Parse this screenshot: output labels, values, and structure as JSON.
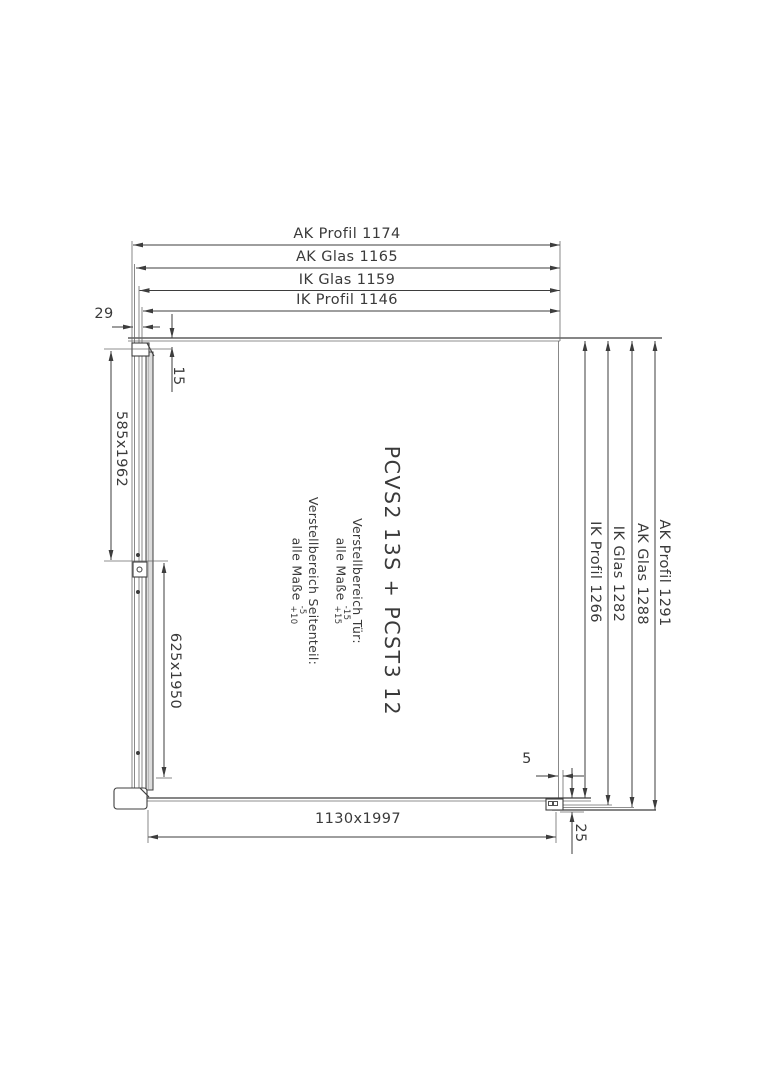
{
  "labels": {
    "top_ak_profil": "AK Profil 1174",
    "top_ak_glas": "AK Glas 1165",
    "top_ik_glas": "IK Glas 1159",
    "top_ik_profil": "IK Profil 1146",
    "right_ik_profil": "IK Profil 1266",
    "right_ik_glas": "IK Glas 1282",
    "right_ak_glas": "AK Glas 1288",
    "right_ak_profil": "AK Profil 1291",
    "wall_profile_width": "29",
    "top_inset": "15",
    "door_glass_size": "585x1962",
    "door_assembly_size": "625x1950",
    "side_panel_size": "1130x1997",
    "bottom_gap": "5",
    "bottom_rail_height": "25"
  },
  "center": {
    "product": "PCVS2 13S + PCST3 12",
    "door_adjust_title": "Verstellbereich Tür:",
    "door_adjust_prefix": "alle Maße",
    "door_tol_top": "-15",
    "door_tol_bottom": "+15",
    "side_adjust_title": "Verstellbereich Seitenteil:",
    "side_adjust_prefix": "alle Maße",
    "side_tol_top": "-5",
    "side_tol_bottom": "+10"
  },
  "colors": {
    "line": "#3d3d3d",
    "text": "#3a3a3a",
    "profile_fill": "#dcdcdc",
    "background": "#ffffff"
  }
}
